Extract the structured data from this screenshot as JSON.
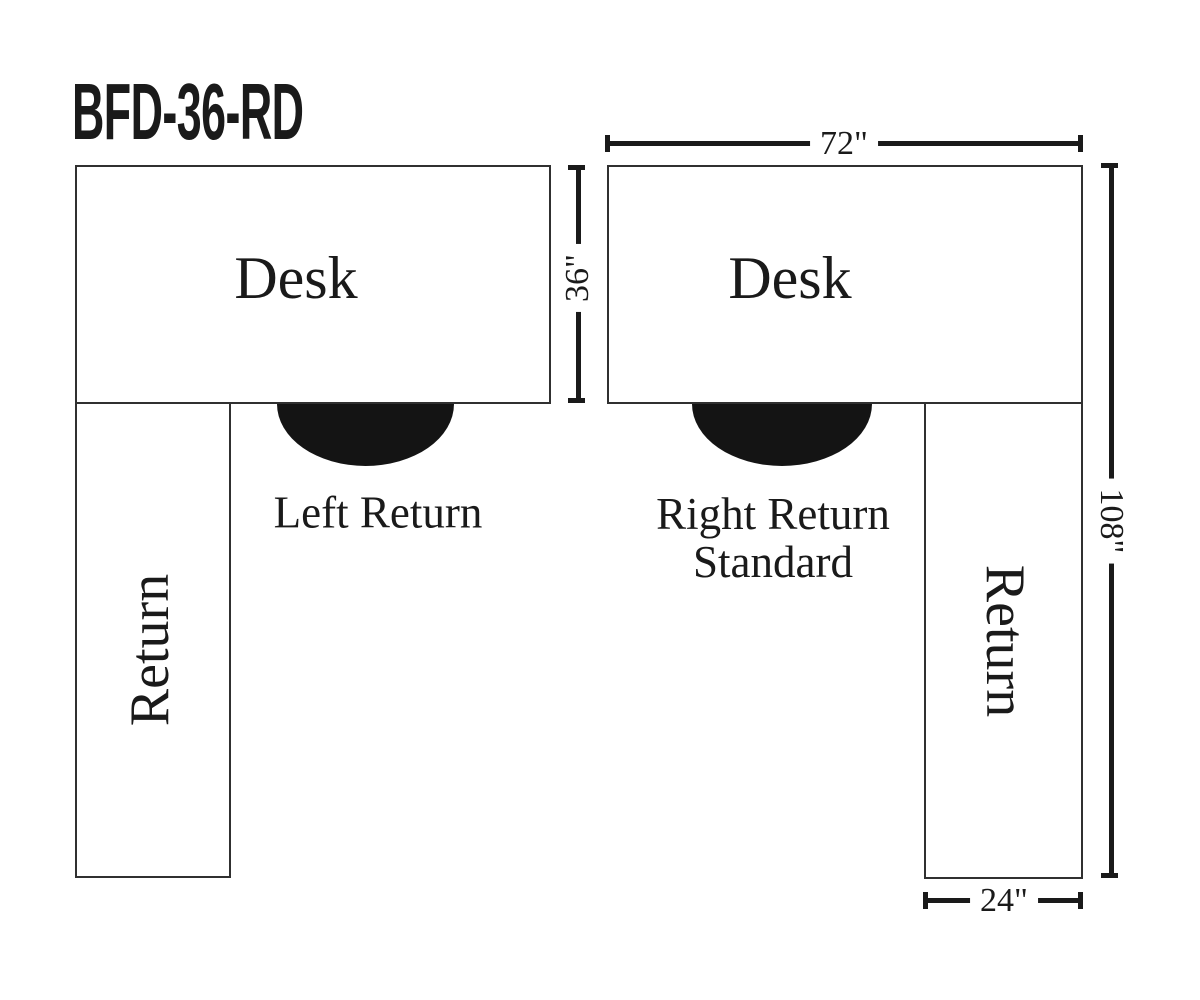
{
  "title": "BFD-36-RD",
  "colors": {
    "ink": "#1a1a1a",
    "outline": "#303030",
    "background": "#ffffff",
    "seat": "#141414"
  },
  "left_unit": {
    "desk_label": "Desk",
    "return_label": "Return",
    "caption": "Left Return"
  },
  "right_unit": {
    "desk_label": "Desk",
    "return_label": "Return",
    "caption_line1": "Right Return",
    "caption_line2": "Standard"
  },
  "dimensions": {
    "desk_width": "72\"",
    "desk_depth": "36\"",
    "overall_depth": "108\"",
    "return_width": "24\""
  }
}
